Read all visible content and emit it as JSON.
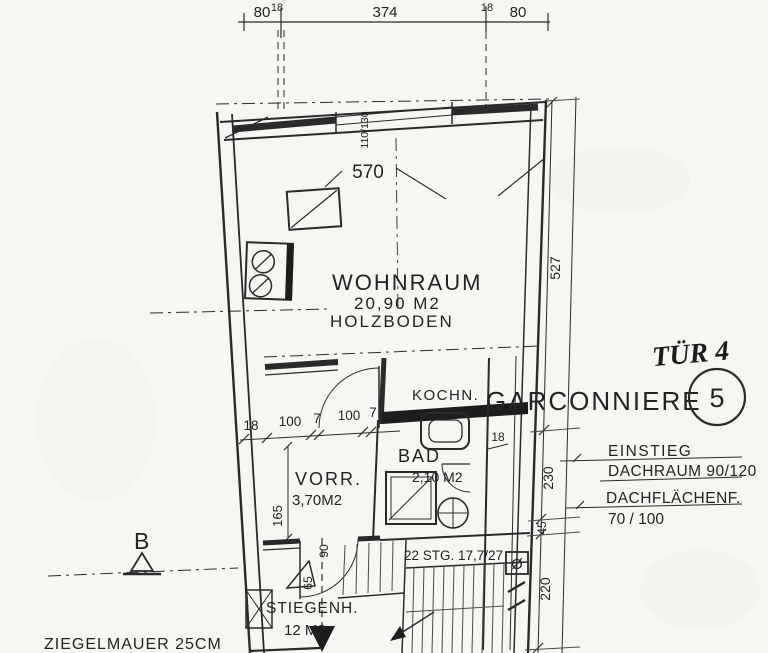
{
  "dims": {
    "top_chain": [
      "80",
      "18",
      "374",
      "18",
      "80"
    ],
    "left_chain": [
      "18",
      "100",
      "7",
      "100",
      "7"
    ],
    "right_chain": [
      "527",
      "230",
      "45",
      "220"
    ],
    "window": "110/130",
    "room_width": "570",
    "vorr_depth": "165",
    "door_width": "90",
    "step": "65",
    "wall": "18"
  },
  "rooms": {
    "wohnraum": {
      "name": "WOHNRAUM",
      "area": "20,90 M2",
      "floor": "HOLZBODEN"
    },
    "kochn": {
      "name": "KOCHN."
    },
    "bad": {
      "name": "BAD",
      "area": "2,10 M2"
    },
    "vorr": {
      "name": "VORR.",
      "area": "3,70M2"
    },
    "stiegenhaus": {
      "name": "STIEGENH.",
      "area": "12 M2"
    }
  },
  "stairs": {
    "note": "22 STG. 17,7/27",
    "shaft": "Ø"
  },
  "notes": {
    "tuer": "TÜR 4",
    "unit_name": "GARCONNIERE",
    "unit_number": "5",
    "einstieg_1": "EINSTIEG",
    "einstieg_2": "DACHRAUM 90/120",
    "dach_1": "DACHFLÄCHENF.",
    "dach_2": "70 / 100",
    "wall_material": "ZIEGELMAUER 25CM",
    "section": "B"
  }
}
